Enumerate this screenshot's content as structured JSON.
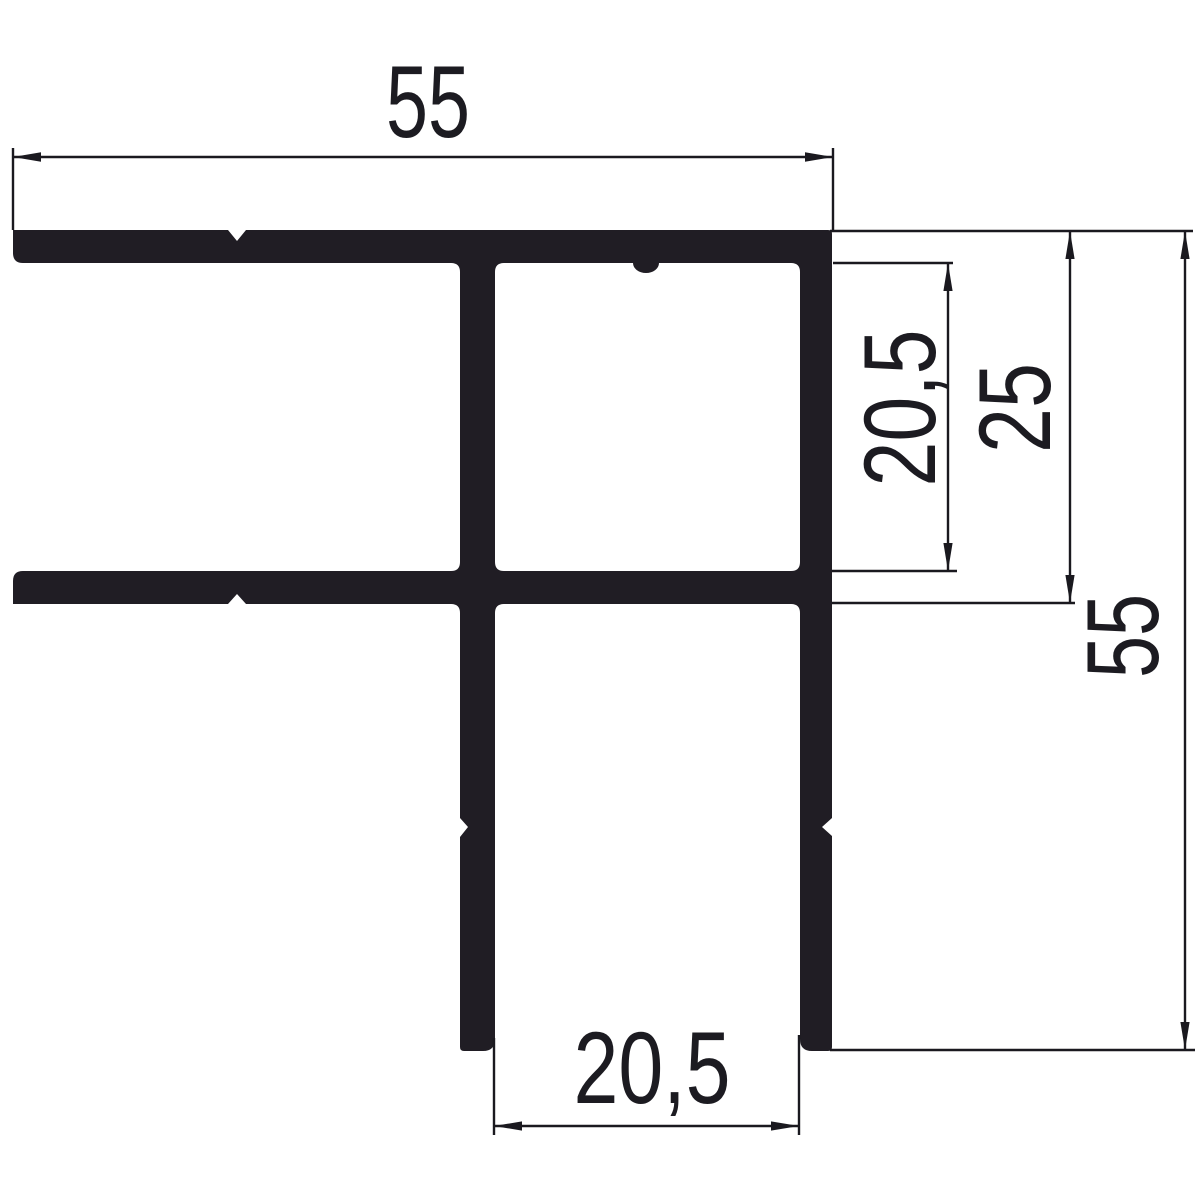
{
  "drawing": {
    "description": "Aluminium profile cross-section with dimension lines",
    "colors": {
      "profile": "#201d24",
      "line": "#1a191f",
      "label": "#1c1b21",
      "background": "#ffffff"
    },
    "dimensions": {
      "top_width": {
        "label": "55"
      },
      "right_inner_gap": {
        "label": "20,5"
      },
      "right_outer_gap": {
        "label": "25"
      },
      "right_height": {
        "label": "55"
      },
      "bottom_channel_width": {
        "label": "20,5"
      }
    }
  }
}
